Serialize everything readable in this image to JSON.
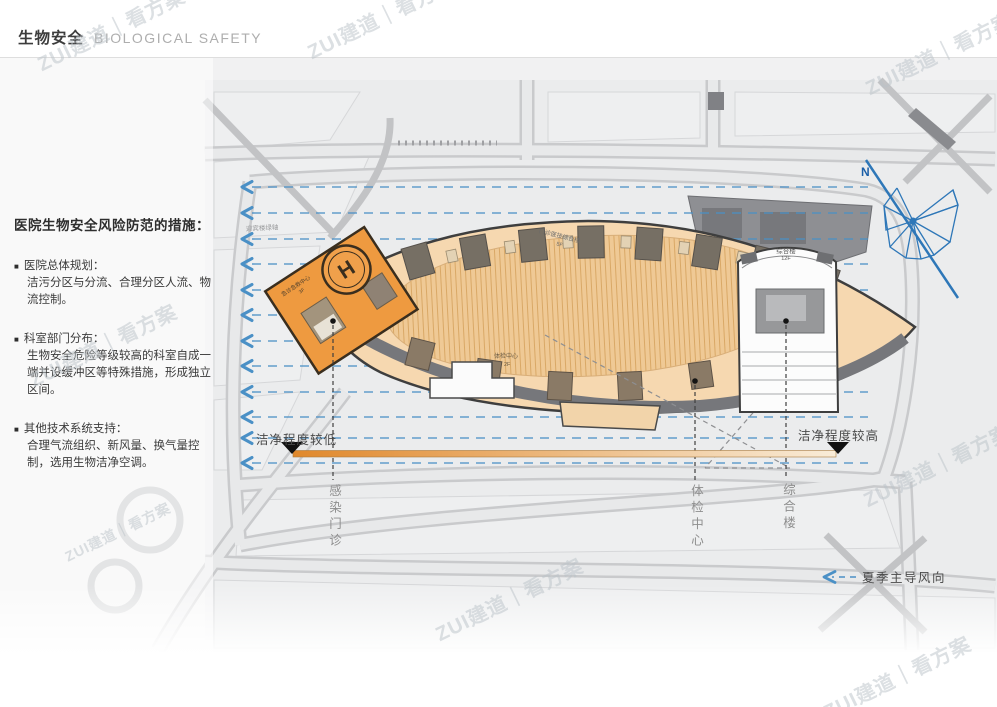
{
  "header": {
    "title_zh": "生物安全",
    "title_en": "BIOLOGICAL SAFETY"
  },
  "measures": {
    "title": "医院生物安全风险防范的措施：",
    "bullet": "■",
    "items": [
      {
        "heading": "医院总体规划：",
        "body": "洁污分区与分流、合理分区人流、物流控制。"
      },
      {
        "heading": "科室部门分布：",
        "body": "生物安全危险等级较高的科室自成一端并设缓冲区等特殊措施，形成独立区间。"
      },
      {
        "heading": "其他技术系统支持：",
        "body": "合理气流组织、新风量、换气量控制，选用生物洁净空调。"
      }
    ]
  },
  "map": {
    "north_label": "N",
    "axis_label": "迎宾楼绿轴",
    "buildings": {
      "emergency": {
        "label": "急诊急救中心",
        "floor": "3F",
        "helipad": "H"
      },
      "outpatient": {
        "label": "门诊医技综合楼",
        "floor": "5F"
      },
      "checkup": {
        "label": "体检中心",
        "floor": "2F"
      },
      "complex": {
        "label": "综合楼",
        "floor": "12F"
      }
    },
    "leaders": {
      "infection": "感染门诊",
      "checkup": "体检中心",
      "complex": "综合楼"
    },
    "gradient": {
      "left": "洁净程度较低",
      "right": "洁净程度较高",
      "from": "#E0882B",
      "to": "#F9ECD8"
    },
    "wind_label": "夏季主导风向",
    "colors": {
      "arrow_blue": "#4A90C6",
      "orange": "#EE9A40",
      "tan": "#F6D8B0",
      "courtyard": "#EFC995",
      "dark_roof": "#766F64",
      "road_gray": "#D9DADC"
    }
  },
  "watermark": {
    "text": "ZUI建道｜看方案"
  }
}
